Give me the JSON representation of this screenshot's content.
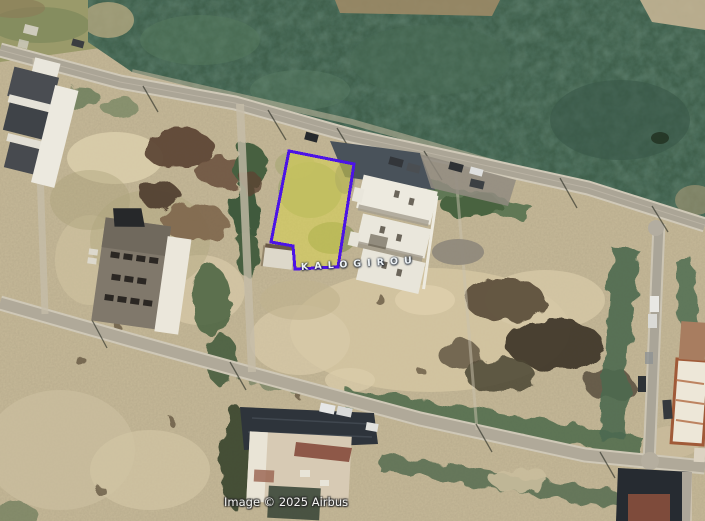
{
  "labels": {
    "street": "KALOGIROU",
    "attribution": "Image © 2025 Airbus"
  },
  "parcel": {
    "points": "289,151 354,164 338,267 295,269 293,246 271,242",
    "fill": "#d9d44e",
    "fill_opacity": "0.55",
    "stroke": "#4c13e6",
    "stroke_width": "3"
  },
  "palette": {
    "vegetation_field": "#40604c",
    "dirt_ground": "#c6b998",
    "sand_patch": "#d3c4a1",
    "road_asphalt": "#aba596",
    "parcel_outline": "#4c13e6",
    "parcel_fill": "#d9d44e"
  }
}
